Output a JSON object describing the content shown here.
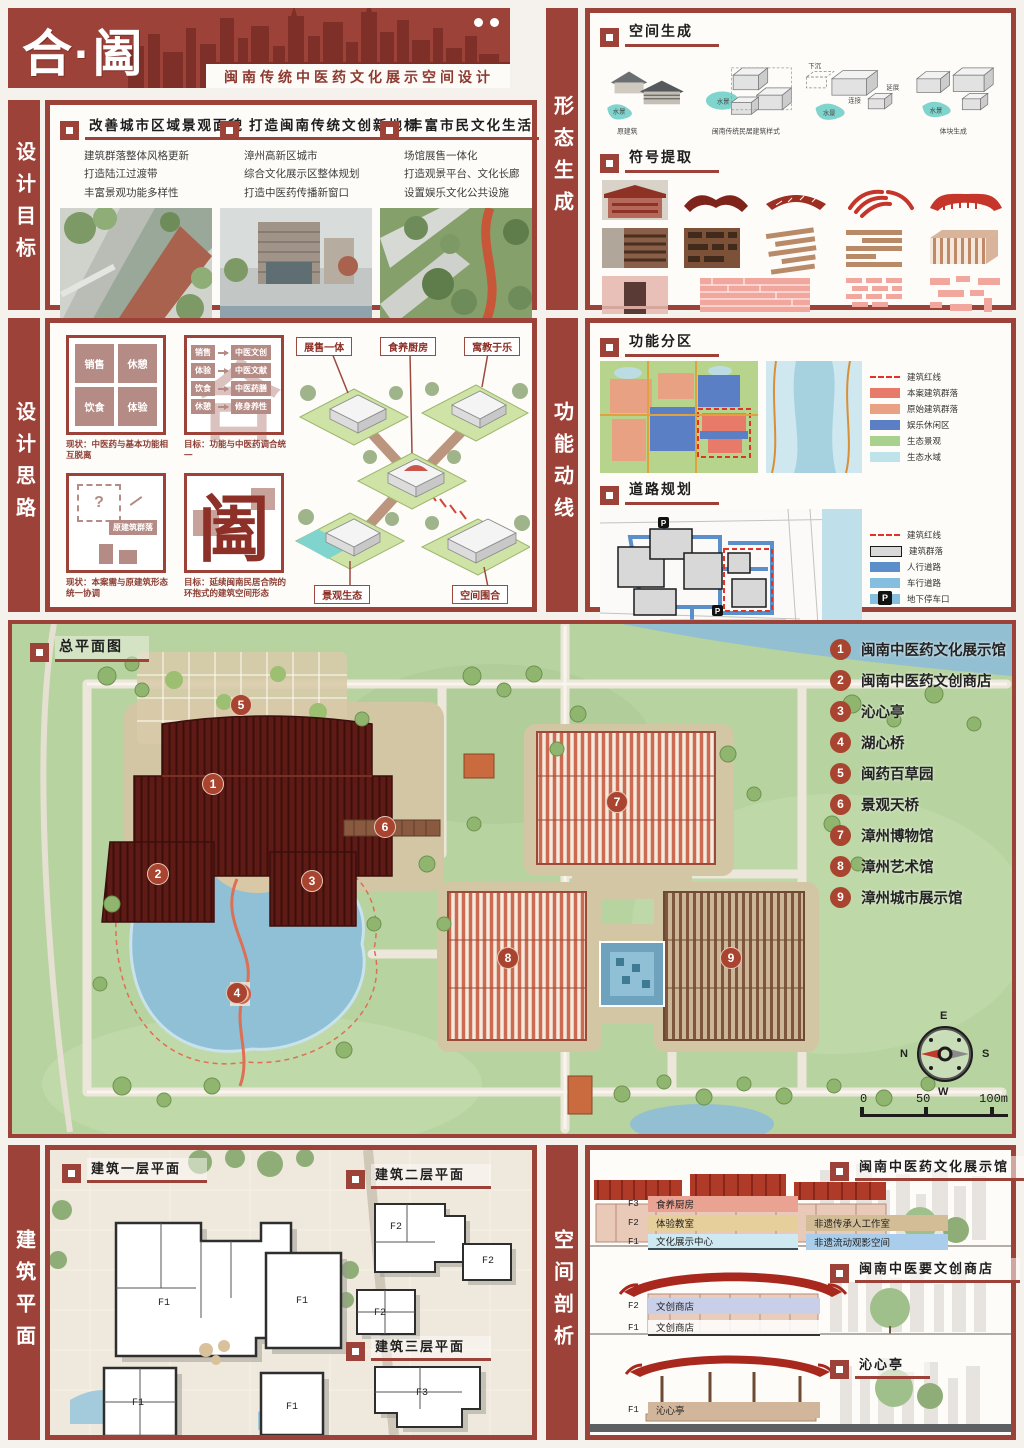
{
  "header": {
    "title": "合·阖",
    "subtitle": "闽南传统中医药文化展示空间设计"
  },
  "sidebars": {
    "design_goals": "设计目标",
    "form_generation": "形态生成",
    "design_thinking": "设计思路",
    "function_circulation": "功能动线",
    "floor_plans": "建筑平面",
    "space_analysis": "空间剖析"
  },
  "design_goals": {
    "columns": [
      {
        "title": "改善城市区域景观面貌",
        "bullets": [
          "建筑群落整体风格更新",
          "打造陆江过渡带",
          "丰富景观功能多样性"
        ]
      },
      {
        "title": "打造闽南传统文创新地标",
        "bullets": [
          "漳州高新区城市",
          "综合文化展示区整体规划",
          "打造中医药传播新窗口"
        ]
      },
      {
        "title": "丰富市民文化生活",
        "bullets": [
          "场馆展售一体化",
          "打造观景平台、文化长廊",
          "设置娱乐文化公共设施"
        ]
      }
    ]
  },
  "form_generation": {
    "space_gen_title": "空间生成",
    "symbol_title": "符号提取",
    "water": "水景",
    "captions": [
      "原建筑",
      "闽南传统民居建筑样式",
      "体块生成"
    ],
    "notes": {
      "sink": "下沉",
      "link": "连接",
      "extend": "延展"
    }
  },
  "design_thinking": {
    "quad": [
      "销售",
      "休憩",
      "饮食",
      "体验"
    ],
    "caption1": "现状：中医药与基本功能相互脱离",
    "pairs": [
      [
        "销售",
        "中医文创"
      ],
      [
        "体验",
        "中医文献"
      ],
      [
        "饮食",
        "中医药膳"
      ],
      [
        "休憩",
        "修身养性"
      ]
    ],
    "caption2": "目标：功能与中医药调合统一",
    "question": "?",
    "orig_label": "原建筑群落",
    "caption3": "现状：本案需与原建筑形态统一协调",
    "glyph_he": "合",
    "glyph_he2": "阖",
    "caption4": "目标：延续闽南民居合院的环抱式的建筑空间形态",
    "iso_labels": [
      "展售一体",
      "食养厨房",
      "寓教于乐",
      "景观生态",
      "空间围合"
    ]
  },
  "function_circulation": {
    "zoning": {
      "title": "功能分区",
      "legend": [
        "建筑红线",
        "本案建筑群落",
        "原始建筑群落",
        "娱乐休闲区",
        "生态景观",
        "生态水域"
      ],
      "colors": {
        "case": "#e87a6a",
        "original": "#e8a183",
        "leisure": "#5b7fc4",
        "eco": "#a9d18e",
        "water": "#bfe3ea"
      }
    },
    "roads": {
      "title": "道路规划",
      "legend": [
        "建筑红线",
        "建筑群落",
        "人行道路",
        "车行道路",
        "地下停车口"
      ],
      "parking_glyph": "P",
      "colors": {
        "building": "#d9d9d9",
        "walk": "#5b8fc9",
        "drive": "#85bfdf"
      }
    }
  },
  "master_plan": {
    "title": "总平面图",
    "legend": [
      {
        "num": "1",
        "name": "闽南中医药文化展示馆"
      },
      {
        "num": "2",
        "name": "闽南中医药文创商店"
      },
      {
        "num": "3",
        "name": "沁心亭"
      },
      {
        "num": "4",
        "name": "湖心桥"
      },
      {
        "num": "5",
        "name": "闽药百草园"
      },
      {
        "num": "6",
        "name": "景观天桥"
      },
      {
        "num": "7",
        "name": "漳州博物馆"
      },
      {
        "num": "8",
        "name": "漳州艺术馆"
      },
      {
        "num": "9",
        "name": "漳州城市展示馆"
      }
    ],
    "scale": [
      "0",
      "50",
      "100m"
    ],
    "compass": {
      "n": "N",
      "e": "E",
      "s": "S",
      "w": "W"
    }
  },
  "floor_plans": {
    "plan1": "建筑一层平面",
    "plan2": "建筑二层平面",
    "plan3": "建筑三层平面",
    "f1": "F1",
    "f2": "F2",
    "f3": "F3"
  },
  "space_analysis": {
    "buildings": [
      {
        "title": "闽南中医药文化展示馆",
        "floors": [
          {
            "level": "F3",
            "name": "食养厨房",
            "extra": ""
          },
          {
            "level": "F2",
            "name": "体验教室",
            "extra": "非遗传承人工作室"
          },
          {
            "level": "F1",
            "name": "文化展示中心",
            "extra": "非遗流动观影空间"
          }
        ]
      },
      {
        "title": "闽南中医要文创商店",
        "floors": [
          {
            "level": "F2",
            "name": "文创商店",
            "extra": ""
          },
          {
            "level": "F1",
            "name": "文创商店",
            "extra": ""
          }
        ]
      },
      {
        "title": "沁心亭",
        "floors": [
          {
            "level": "F1",
            "name": "沁心亭",
            "extra": ""
          }
        ]
      }
    ]
  },
  "colors": {
    "primary": "#9c4238",
    "silhouette": "#7e2f28",
    "accent": "#a8442f",
    "teal": "#7fd4cd",
    "site_green": "#b7d3a0",
    "lake": "#8fc0d6"
  }
}
